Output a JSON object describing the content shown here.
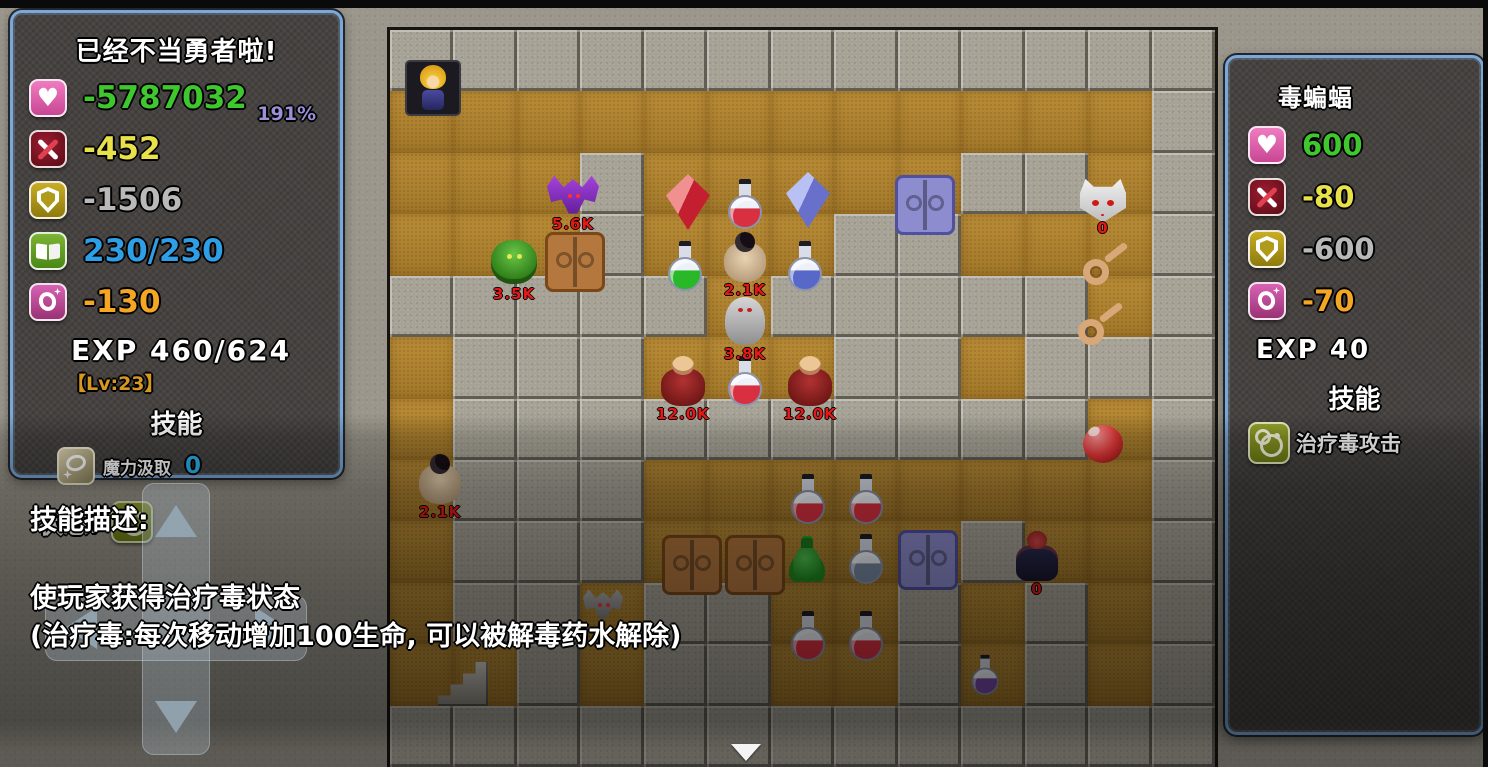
{
  "player_panel": {
    "title": "已经不当勇者啦!",
    "stats": [
      {
        "icon": "heart-icon",
        "value": "-5787032",
        "color": "#3ec82e",
        "extra": "191%",
        "extra_color": "#9b8fd8"
      },
      {
        "icon": "attack-icon",
        "value": "-452",
        "color": "#e8e14a"
      },
      {
        "icon": "defense-icon",
        "value": "-1506",
        "color": "#b9b9b9"
      },
      {
        "icon": "book-icon",
        "value": "230/230",
        "color": "#2e9fe6"
      },
      {
        "icon": "magic-icon",
        "value": "-130",
        "color": "#f5a623"
      }
    ],
    "exp_line": "EXP  460/624",
    "level": "【Lv:23】",
    "skills_header": "技能",
    "skill": {
      "name": "魔力汲取",
      "value": "0"
    },
    "status_label": "状态:"
  },
  "enemy_panel": {
    "name": "毒蝙蝠",
    "stats": [
      {
        "icon": "heart-icon",
        "value": "600",
        "color": "#3ec82e"
      },
      {
        "icon": "attack-icon",
        "value": "-80",
        "color": "#e8e14a"
      },
      {
        "icon": "defense-icon",
        "value": "-600",
        "color": "#b9b9b9"
      },
      {
        "icon": "magic-icon",
        "value": "-70",
        "color": "#f5a623"
      }
    ],
    "exp_line": "EXP  40",
    "skills_header": "技能",
    "skill_name": "治疗毒攻击"
  },
  "skill_description": {
    "header": "技能描述:",
    "line1": "使玩家获得治疗毒状态",
    "line2": "(治疗毒:每次移动增加100生命, 可以被解毒药水解除)"
  },
  "maze": {
    "legend": {
      "wall": "#",
      "floor": "."
    },
    "tilemap": [
      "#############",
      "............#",
      "...#.....##.#",
      "...#...##...#",
      "#####.#####.#",
      ".###...##.###",
      ".##########.#",
      ".###........#",
      ".###.....#..#",
      ".##.##..#.#.#",
      "..#.##..#.#.#",
      "#############"
    ],
    "label_color": "#e81818",
    "entities": [
      {
        "name": "hero-sprite",
        "type": "player",
        "x": 15,
        "y": 30
      },
      {
        "name": "purple-bat-enemy",
        "type": "bat",
        "color": "purple",
        "x": 157,
        "y": 144,
        "label": "5.6K"
      },
      {
        "name": "green-monster-enemy",
        "type": "monster",
        "x": 96,
        "y": 202,
        "label": "3.5K"
      },
      {
        "name": "dungeon-door",
        "type": "door",
        "color": "brown",
        "x": 155,
        "y": 202
      },
      {
        "name": "red-crystal-item",
        "type": "crystal",
        "color": "red",
        "x": 276,
        "y": 144
      },
      {
        "name": "red-potion-item",
        "type": "potion",
        "color": "red",
        "x": 327,
        "y": 145
      },
      {
        "name": "blue-crystal-item",
        "type": "crystal",
        "color": "blue",
        "x": 396,
        "y": 142
      },
      {
        "name": "dungeon-door",
        "type": "door",
        "color": "purple",
        "x": 505,
        "y": 145
      },
      {
        "name": "green-potion-item",
        "type": "potion",
        "color": "green",
        "x": 267,
        "y": 207
      },
      {
        "name": "mummy-enemy",
        "type": "mummy",
        "x": 327,
        "y": 198,
        "label": "2.1K"
      },
      {
        "name": "blue-potion-item",
        "type": "potion",
        "color": "blue",
        "x": 387,
        "y": 207
      },
      {
        "name": "ghost-enemy",
        "type": "ghost",
        "x": 327,
        "y": 262,
        "label": "3.8K"
      },
      {
        "name": "red-warrior-enemy",
        "type": "warrior",
        "x": 265,
        "y": 322,
        "label": "12.0K"
      },
      {
        "name": "red-potion-item",
        "type": "potion",
        "color": "red",
        "x": 327,
        "y": 322
      },
      {
        "name": "red-warrior-enemy",
        "type": "warrior",
        "x": 392,
        "y": 322,
        "label": "12.0K"
      },
      {
        "name": "skull-bat-enemy",
        "type": "skull",
        "x": 690,
        "y": 148,
        "label": "0"
      },
      {
        "name": "key-item",
        "type": "key",
        "x": 687,
        "y": 207
      },
      {
        "name": "key-item",
        "type": "key",
        "x": 682,
        "y": 267
      },
      {
        "name": "red-orb-item",
        "type": "orb",
        "x": 685,
        "y": 385
      },
      {
        "name": "mummy-enemy",
        "type": "mummy",
        "x": 22,
        "y": 420,
        "label": "2.1K"
      },
      {
        "name": "gray-bat-enemy",
        "type": "bat",
        "color": "gray",
        "x": 193,
        "y": 558
      },
      {
        "name": "dungeon-door",
        "type": "door",
        "color": "brown",
        "x": 272,
        "y": 505
      },
      {
        "name": "dungeon-door",
        "type": "door",
        "color": "brown",
        "x": 335,
        "y": 505
      },
      {
        "name": "green-urn-item",
        "type": "urn",
        "x": 389,
        "y": 500
      },
      {
        "name": "silver-potion-item",
        "type": "potion",
        "color": "silver",
        "x": 448,
        "y": 500
      },
      {
        "name": "dungeon-door",
        "type": "door",
        "color": "purple",
        "x": 508,
        "y": 500
      },
      {
        "name": "red-wizard-enemy",
        "type": "wizard",
        "x": 619,
        "y": 497,
        "label": "0"
      },
      {
        "name": "red-potion-item",
        "type": "potion",
        "color": "red",
        "x": 390,
        "y": 440
      },
      {
        "name": "red-potion-item",
        "type": "potion",
        "color": "red",
        "x": 448,
        "y": 440
      },
      {
        "name": "red-potion-item",
        "type": "potion",
        "color": "red",
        "x": 390,
        "y": 577
      },
      {
        "name": "red-potion-item",
        "type": "potion",
        "color": "red",
        "x": 448,
        "y": 577
      },
      {
        "name": "purple-potion-item",
        "type": "potion",
        "color": "purple",
        "x": 567,
        "y": 616
      },
      {
        "name": "stairs-tile",
        "type": "stairs",
        "x": 48,
        "y": 632
      }
    ]
  }
}
